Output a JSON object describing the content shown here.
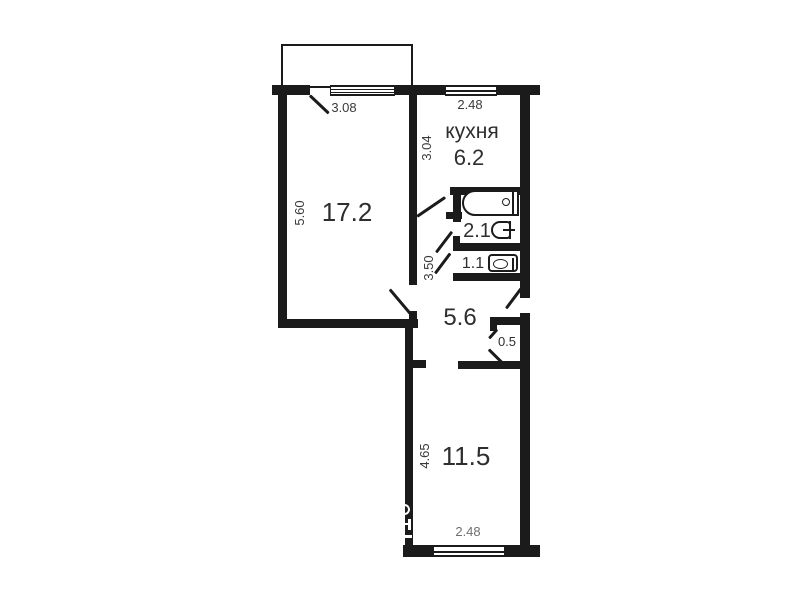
{
  "plan": {
    "rooms": {
      "living": {
        "area": "17.2"
      },
      "kitchen": {
        "name": "кухня",
        "area": "6.2"
      },
      "bathroom": {
        "area": "2.1"
      },
      "wc": {
        "area": "1.1"
      },
      "hall": {
        "area": "5.6"
      },
      "closet": {
        "area": "0.5"
      },
      "bedroom": {
        "area": "11.5"
      }
    },
    "dimensions": {
      "living_width": "3.08",
      "living_depth": "5.60",
      "kitchen_width": "2.48",
      "kitchen_depth": "3.04",
      "hall_depth": "3.50",
      "bedroom_depth": "4.65",
      "bedroom_width": "2.48"
    },
    "colors": {
      "wall": "#1b1b1b",
      "background": "#ffffff",
      "room_text": "#2e2e2e",
      "dim_text": "#3a3a3a",
      "faded_dim_text": "#6f6f6f"
    }
  }
}
